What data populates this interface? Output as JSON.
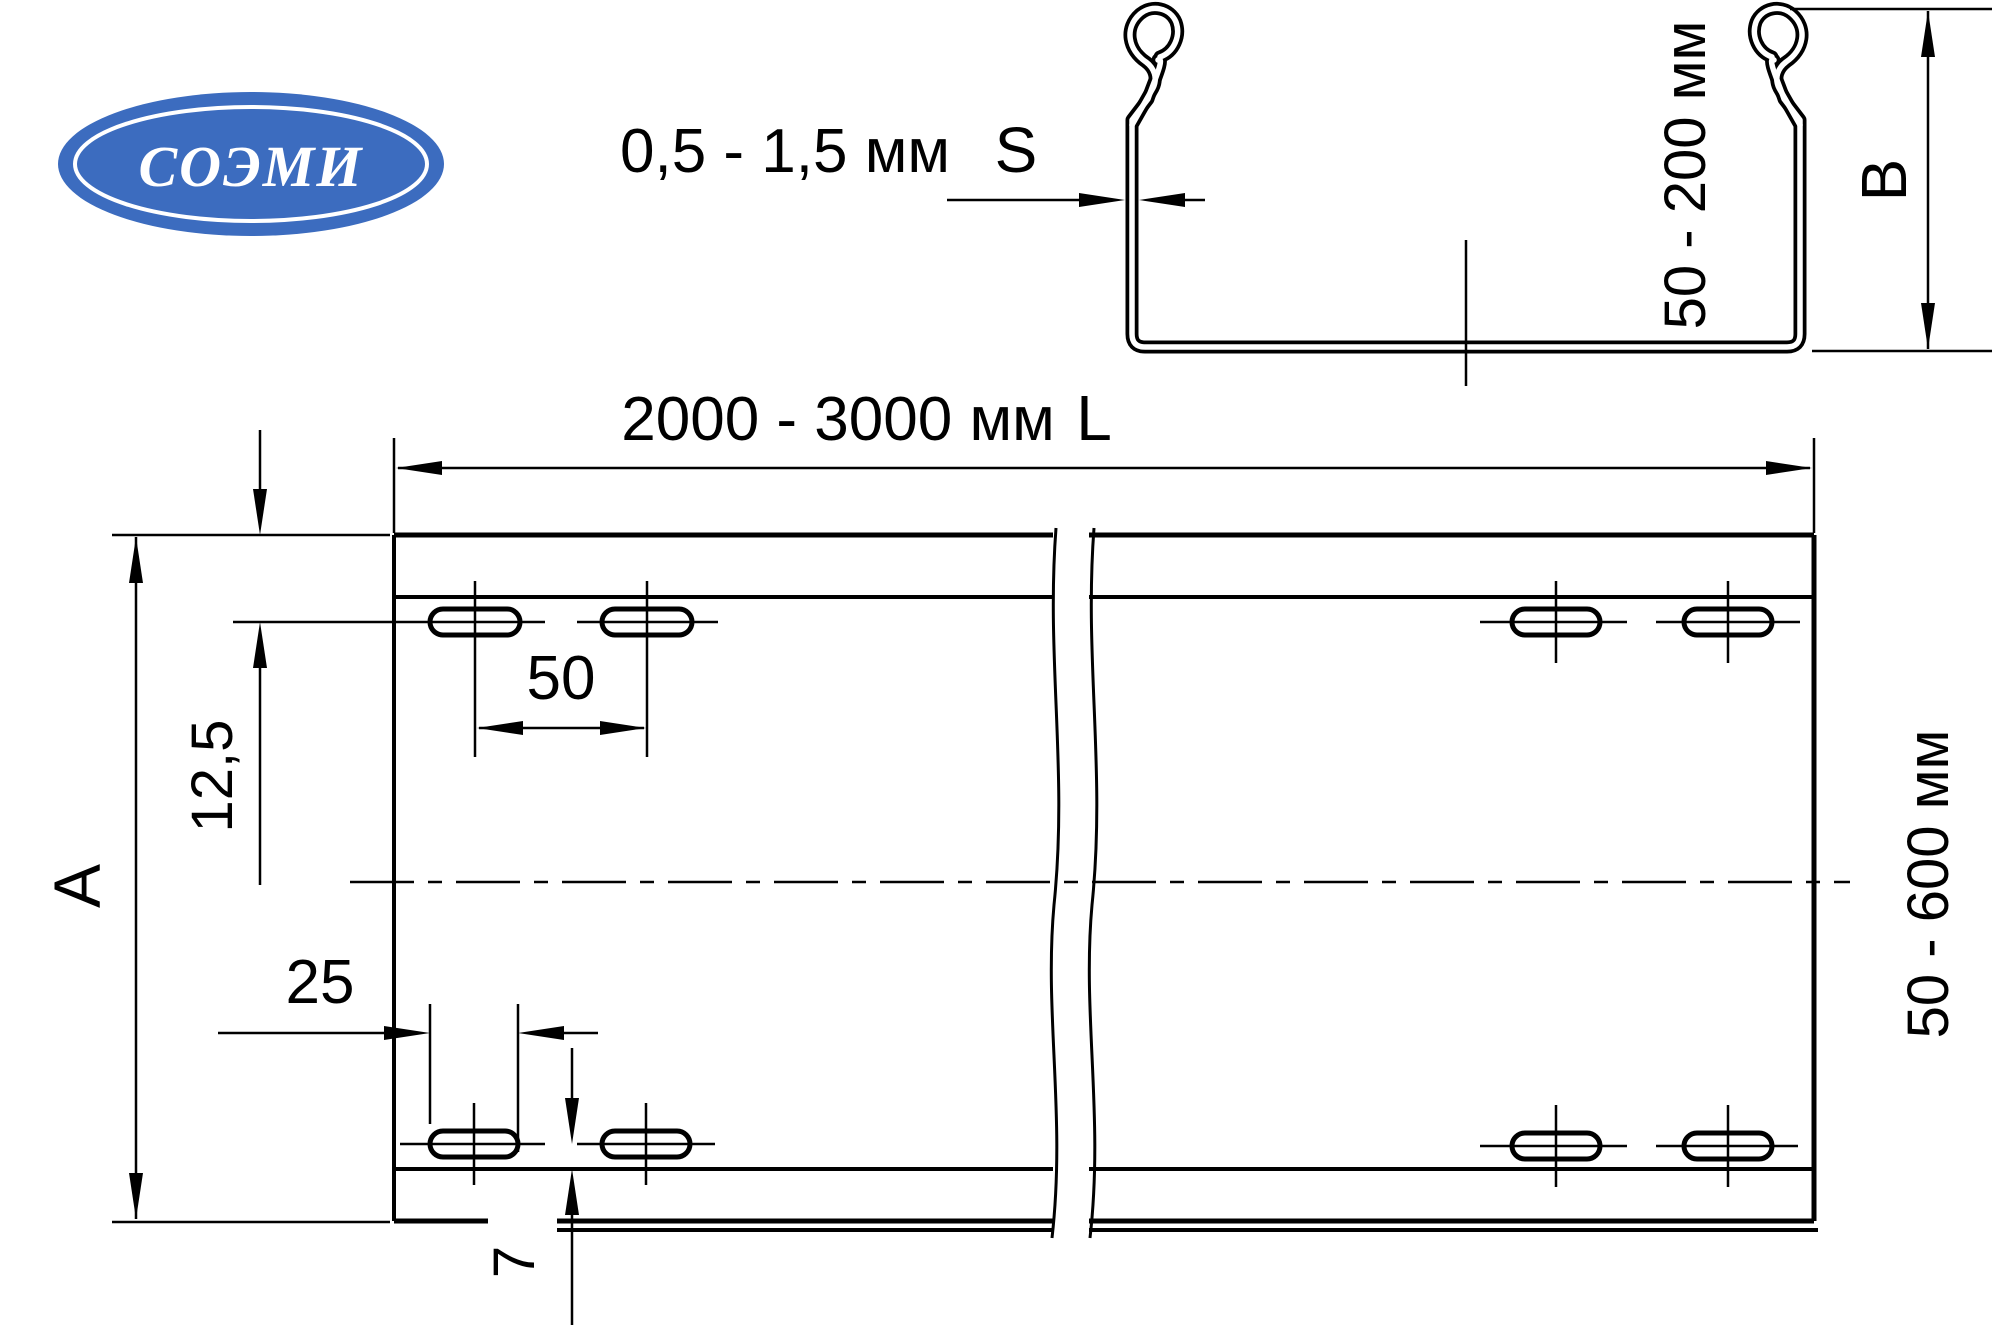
{
  "drawing": {
    "background": "#ffffff",
    "line_color": "#000000",
    "logo": {
      "text": "СОЭМИ",
      "ellipse_color": "#3c6cbf",
      "text_color": "#ffffff"
    },
    "cross_section": {
      "thickness_range": "0,5 - 1,5 мм",
      "thickness_symbol": "S",
      "height_range": "50 - 200 мм",
      "height_symbol": "B"
    },
    "plan": {
      "length_range": "2000 - 3000 мм",
      "length_symbol": "L",
      "width_range": "50 - 600 мм",
      "width_symbol": "A",
      "hole_offset_from_top": "12,5",
      "hole_pitch": "50",
      "hole_length": "25",
      "hole_offset_from_bottom": "7"
    }
  }
}
